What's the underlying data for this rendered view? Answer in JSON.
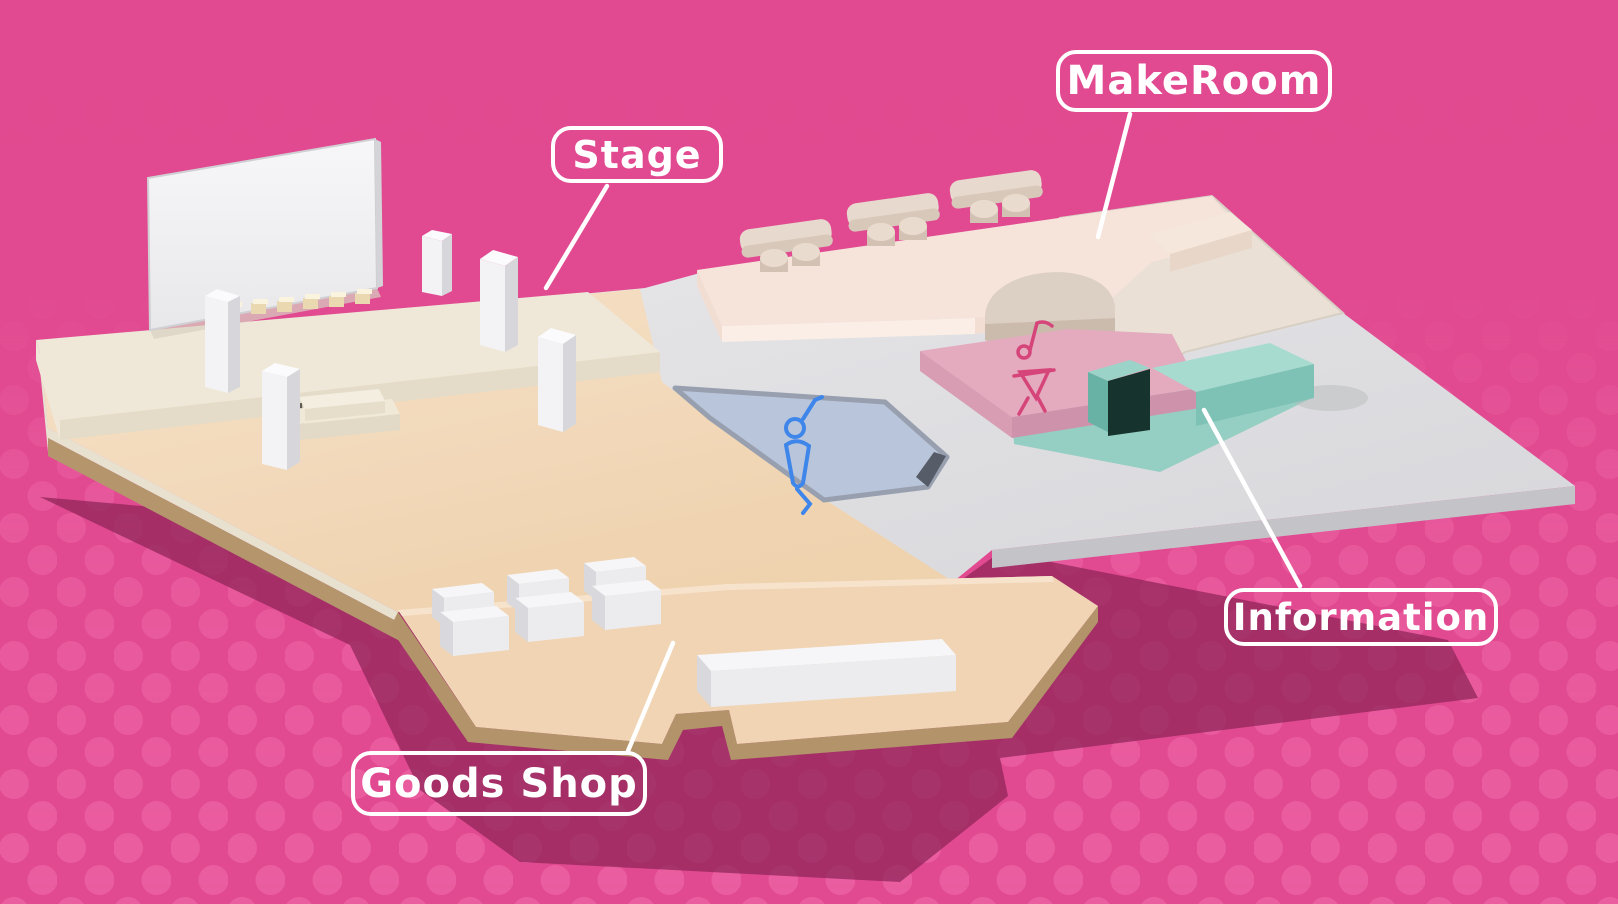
{
  "callouts": [
    {
      "id": "stage",
      "label": "Stage"
    },
    {
      "id": "makeroom",
      "label": "MakeRoom"
    },
    {
      "id": "information",
      "label": "Information"
    },
    {
      "id": "goods_shop",
      "label": "Goods Shop"
    }
  ],
  "map": {
    "background_color": "#e14a90",
    "dot_color": "#f06cab",
    "shadow_color": "#8d2457",
    "label_color": "#ffffff",
    "zones": [
      {
        "id": "stage",
        "floor_color": "#efe8d8"
      },
      {
        "id": "makeroom",
        "floor_color": "#f6e3da"
      },
      {
        "id": "information",
        "floor_color": "#9bd3c8"
      },
      {
        "id": "goods_shop",
        "floor_color": "#f0d4b4"
      },
      {
        "id": "dance-floor-blue",
        "floor_color": "#b9c5db",
        "icon": "dancer-icon",
        "icon_color": "#3f86ea"
      },
      {
        "id": "dance-stage-pink",
        "floor_color": "#e4aabe",
        "icon": "dancing-girl-note-icon",
        "icon_color": "#d6457a"
      }
    ]
  }
}
